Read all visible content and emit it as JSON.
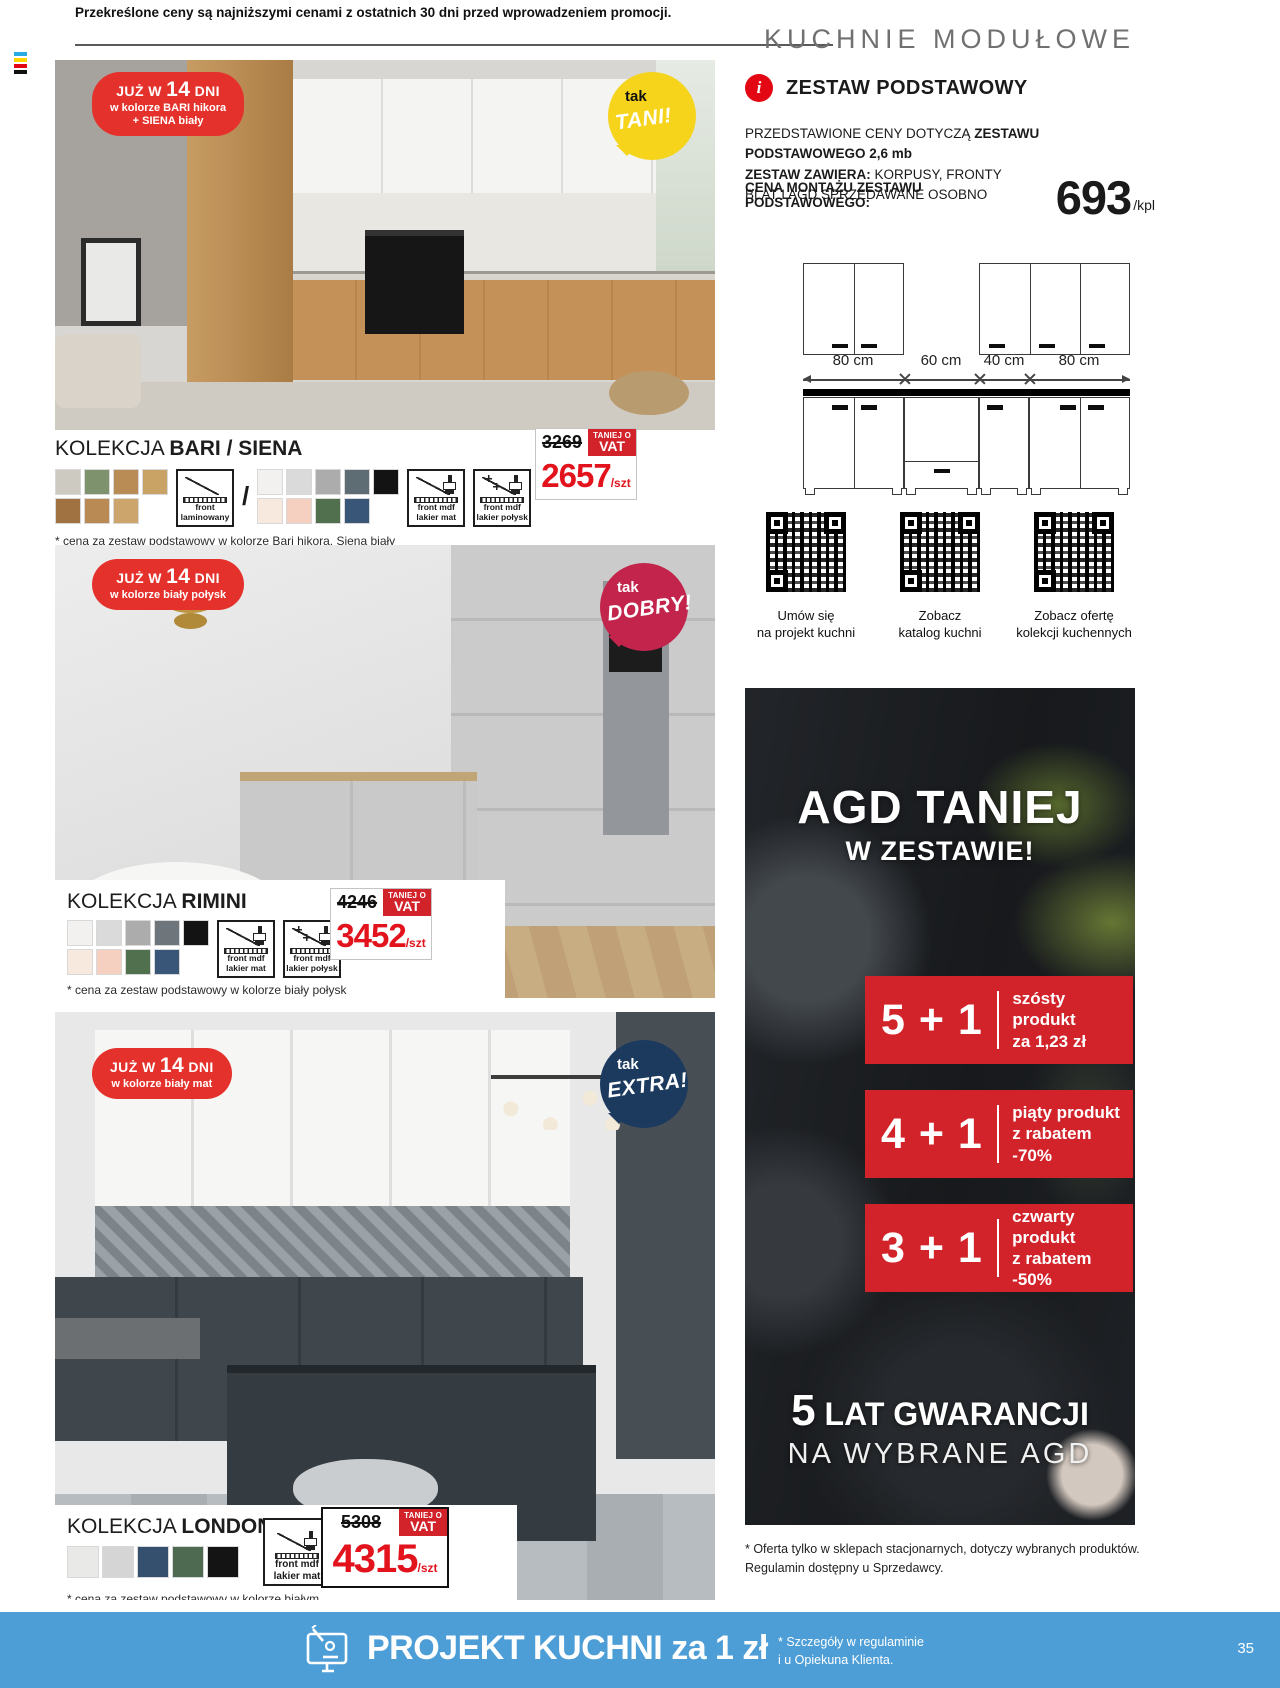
{
  "header": {
    "disclaimer": "Przekreślone ceny są najniższymi cenami z ostatnich 30 dni przed wprowadzeniem promocji.",
    "section_title": "KUCHNIE MODUŁOWE"
  },
  "labels": {
    "kolekcja": "KOLEKCJA",
    "slash": "/",
    "vat_top": "TANIEJ O",
    "vat_bottom": "VAT"
  },
  "products": [
    {
      "name": "BARI / SIENA",
      "badge_prefix": "JUŻ W",
      "badge_days": "14",
      "badge_suffix": "DNI",
      "badge_color1": "w kolorze BARI hikora",
      "badge_color2": "+ SIENA biały",
      "bubble_small": "tak",
      "bubble_big": "TANI!",
      "swatches_a1": [
        "#cdcac1",
        "#7e926e",
        "#b98c55",
        "#c9a266"
      ],
      "swatches_a2": [
        "#a07242",
        "#b98a54",
        "#cba56b"
      ],
      "swatches_b1": [
        "#f2f1ef",
        "#dadada",
        "#acacac",
        "#5e6c74",
        "#131313"
      ],
      "swatches_b2": [
        "#f8e9df",
        "#f5cfc0",
        "#50704e",
        "#395678"
      ],
      "icon_laminate": "front\nlaminowany",
      "icon_mat": "front mdf\nlakier mat",
      "icon_gloss": "front mdf\nlakier połysk",
      "old_price": "3269",
      "price": "2657",
      "unit": "/szt",
      "footnote": "* cena za zestaw podstawowy w kolorze Bari hikora, Siena biały"
    },
    {
      "name": "RIMINI",
      "badge_prefix": "JUŻ W",
      "badge_days": "14",
      "badge_suffix": "DNI",
      "badge_color1": "w kolorze biały połysk",
      "bubble_small": "tak",
      "bubble_big": "DOBRY!",
      "swatches_b1": [
        "#f2f1ef",
        "#dadada",
        "#acacac",
        "#6e757b",
        "#131313"
      ],
      "swatches_b2": [
        "#f8e9df",
        "#f5cfc0",
        "#50704e",
        "#395678"
      ],
      "icon_mat": "front mdf\nlakier mat",
      "icon_gloss": "front mdf\nlakier połysk",
      "old_price": "4246",
      "price": "3452",
      "unit": "/szt",
      "footnote": "* cena za zestaw podstawowy w kolorze biały połysk"
    },
    {
      "name": "LONDON",
      "badge_prefix": "JUŻ W",
      "badge_days": "14",
      "badge_suffix": "DNI",
      "badge_color1": "w kolorze biały mat",
      "bubble_small": "tak",
      "bubble_big": "EXTRA!",
      "swatches_b1": [
        "#e9e9e8",
        "#d5d5d5",
        "#34506e",
        "#4e6a50",
        "#141414"
      ],
      "icon_mat": "front mdf\nlakier mat",
      "old_price": "5308",
      "price": "4315",
      "unit": "/szt",
      "footnote": "* cena za zestaw podstawowy w kolorze białym"
    }
  ],
  "zestaw": {
    "title": "ZESTAW PODSTAWOWY",
    "info_glyph": "i",
    "line1_normal": "PRZEDSTAWIONE CENY DOTYCZĄ",
    "line1_bold": "ZESTAWU PODSTAWOWEGO 2,6 mb",
    "line2_bold": "ZESTAW ZAWIERA:",
    "line2_normal": "KORPUSY, FRONTY",
    "line3": "BLAT I AGD SPRZEDAWANE OSOBNO",
    "montaz_label": "CENA MONTAŻU ZESTAWU PODSTAWOWEGO:",
    "montaz_price": "693",
    "montaz_unit": "/kpl"
  },
  "diagram": {
    "labels": [
      "80 cm",
      "60 cm",
      "40 cm",
      "80 cm"
    ]
  },
  "qr_links": [
    {
      "caption": "Umów się\nna projekt kuchni"
    },
    {
      "caption": "Zobacz\nkatalog kuchni"
    },
    {
      "caption": "Zobacz ofertę\nkolekcji kuchennych"
    }
  ],
  "agd_promo": {
    "title1": "AGD TANIEJ",
    "title2": "W ZESTAWIE!",
    "offers": [
      {
        "big": "5 + 1",
        "line1": "szósty produkt",
        "line2": "za 1,23 zł"
      },
      {
        "big": "4 + 1",
        "line1": "piąty produkt",
        "line2": "z rabatem -70%"
      },
      {
        "big": "3 + 1",
        "line1": "czwarty produkt",
        "line2": "z rabatem -50%"
      }
    ],
    "guarantee_big": "5",
    "guarantee_text": " LAT GWARANCJI",
    "guarantee_sub": "NA WYBRANE AGD",
    "footnote": "* Oferta tylko w sklepach stacjonarnych, dotyczy wybranych produktów.\nRegulamin dostępny u Sprzedawcy."
  },
  "footer": {
    "title": "PROJEKT KUCHNI za 1 zł",
    "note": "* Szczegóły w regulaminie\ni u Opiekuna Klienta.",
    "page_number": "35"
  },
  "colors": {
    "accent_red": "#d2232a",
    "price_red": "#e2131c",
    "badge_red": "#e5312b",
    "bubble_yellow": "#f6d41c",
    "bubble_crimson": "#c2244c",
    "bubble_navy": "#1c3a5e",
    "footer_blue": "#4d9ed6"
  }
}
